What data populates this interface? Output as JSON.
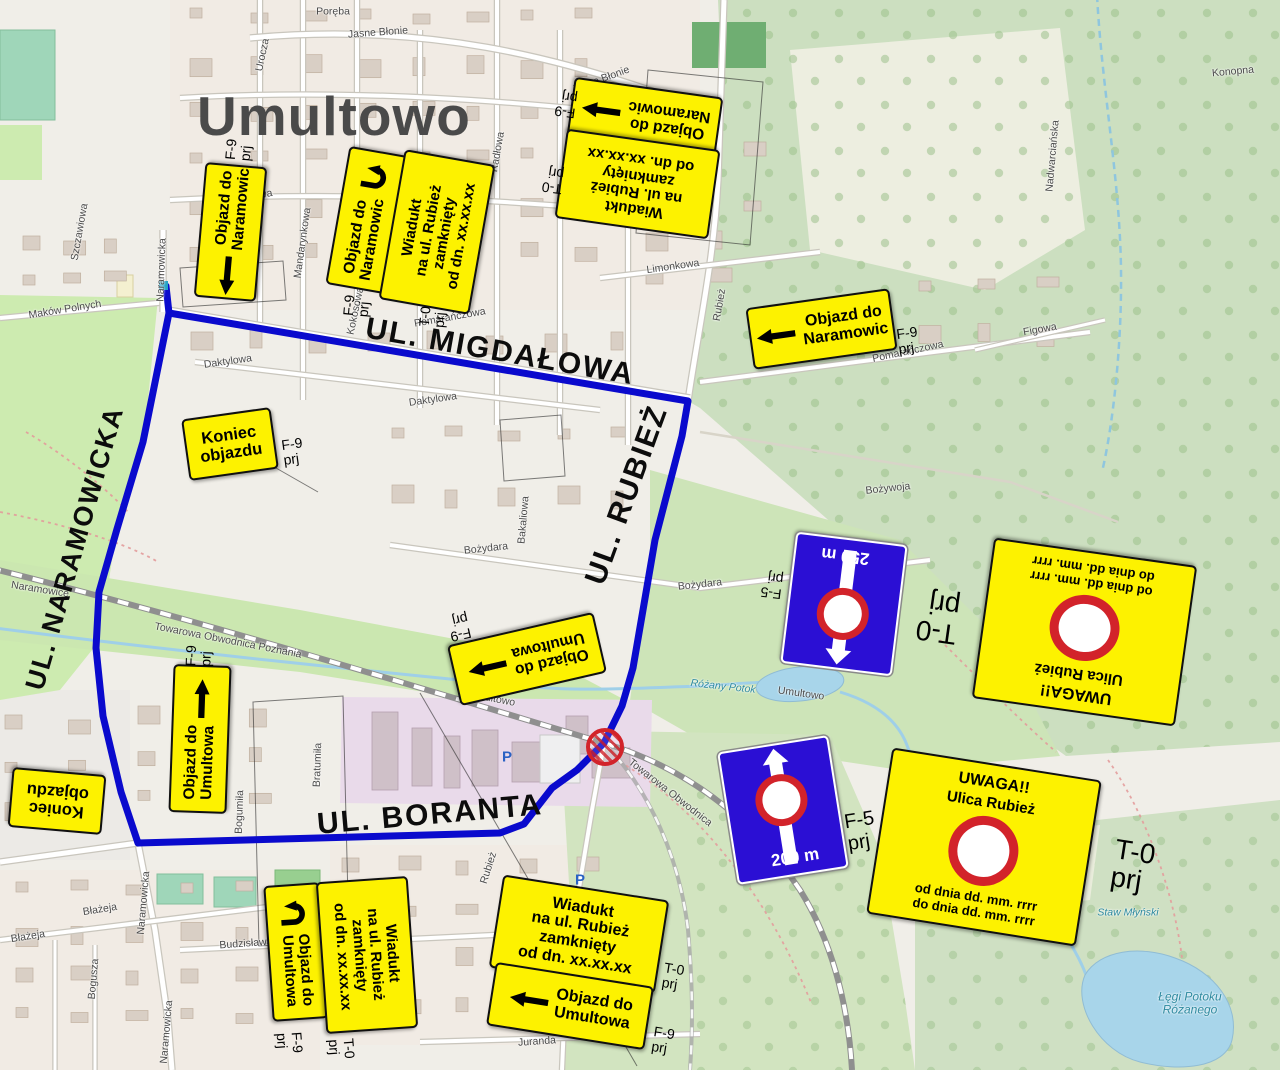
{
  "title": "Umultowo",
  "colors": {
    "route_blue": "#0a0acd",
    "sign_yellow": "#fdf200",
    "sign_blue": "#2b0fd4",
    "prohibition_red": "#d2232a",
    "title_gray": "#4a4a4a"
  },
  "main_streets": {
    "migdalowa": "UL. MIGDAŁOWA",
    "rubiez": "UL. RUBIEŻ",
    "naramowicka": "UL. NARAMOWICKA",
    "boranta": "UL. BORANTA"
  },
  "signs": {
    "objazd_naramowic": "Objazd do\nNaramowic",
    "objazd_umultowa": "Objazd do\nUmultowa",
    "wiadukt": "Wiadukt\nna ul. Rubież\nzamknięty\nod dn. xx.xx.xx",
    "koniec": "Koniec\nobjazdu",
    "uwaga_title": "UWAGA!!",
    "uwaga_subtitle": "Ulica Rubież",
    "uwaga_dates": "od dnia dd. mm. rrrr\ndo dnia dd. mm. rrrr",
    "f5_250": "250 m",
    "f5_200": "200 m"
  },
  "aux_labels": {
    "f9": "F-9\nprj",
    "t0": "T-0\nprj",
    "f5": "F-5\nprj"
  },
  "icons": {
    "parking": "P"
  },
  "map_labels": [
    {
      "t": "Jasne Błonie",
      "x": 378,
      "y": 33,
      "r": -4
    },
    {
      "t": "Jasne Błonie",
      "x": 601,
      "y": 80,
      "r": -20
    },
    {
      "t": "Urocza",
      "x": 263,
      "y": 55,
      "r": -78
    },
    {
      "t": "Poręba",
      "x": 333,
      "y": 12,
      "r": 0
    },
    {
      "t": "Radłowa",
      "x": 498,
      "y": 152,
      "r": -80
    },
    {
      "t": "Koprowa",
      "x": 252,
      "y": 197,
      "r": -10
    },
    {
      "t": "Mandarynkowa",
      "x": 303,
      "y": 243,
      "r": -82
    },
    {
      "t": "Szczawiowa",
      "x": 80,
      "y": 232,
      "r": -80
    },
    {
      "t": "Maków Polnych",
      "x": 65,
      "y": 310,
      "r": -9
    },
    {
      "t": "Kokosowa",
      "x": 356,
      "y": 311,
      "r": -78
    },
    {
      "t": "Pomarańczowa",
      "x": 450,
      "y": 318,
      "r": -10
    },
    {
      "t": "Pomarańczowa",
      "x": 908,
      "y": 352,
      "r": -12
    },
    {
      "t": "Limonkowa",
      "x": 673,
      "y": 267,
      "r": -8
    },
    {
      "t": "Figowa",
      "x": 1040,
      "y": 330,
      "r": -10
    },
    {
      "t": "Daktylowa",
      "x": 228,
      "y": 362,
      "r": -8
    },
    {
      "t": "Daktylowa",
      "x": 433,
      "y": 400,
      "r": -8
    },
    {
      "t": "Bakaliowa",
      "x": 524,
      "y": 520,
      "r": -85
    },
    {
      "t": "Bożydara",
      "x": 486,
      "y": 549,
      "r": -6
    },
    {
      "t": "Bożydara",
      "x": 700,
      "y": 585,
      "r": -6
    },
    {
      "t": "Bożywoja",
      "x": 888,
      "y": 489,
      "r": -6
    },
    {
      "t": "Rubież",
      "x": 720,
      "y": 305,
      "r": -80
    },
    {
      "t": "Rubież",
      "x": 489,
      "y": 868,
      "r": -72
    },
    {
      "t": "Naramowicka",
      "x": 162,
      "y": 270,
      "r": -88
    },
    {
      "t": "Naramowicka",
      "x": 144,
      "y": 903,
      "r": -85
    },
    {
      "t": "Naramowicka",
      "x": 167,
      "y": 1032,
      "r": -85
    },
    {
      "t": "Towarowa Obwodnica Poznania",
      "x": 228,
      "y": 641,
      "r": 11
    },
    {
      "t": "Towarowa Obwodnica",
      "x": 670,
      "y": 793,
      "r": 38
    },
    {
      "t": "Umultowo",
      "x": 492,
      "y": 699,
      "r": 11
    },
    {
      "t": "Umultowo",
      "x": 801,
      "y": 694,
      "r": 8
    },
    {
      "t": "Naramowice",
      "x": 40,
      "y": 590,
      "r": 9
    },
    {
      "t": "Różany Potok",
      "x": 723,
      "y": 687,
      "r": 6,
      "c": "water"
    },
    {
      "t": "Błażeja",
      "x": 100,
      "y": 910,
      "r": -9
    },
    {
      "t": "Błażeja",
      "x": 28,
      "y": 937,
      "r": -9
    },
    {
      "t": "Bogusza",
      "x": 94,
      "y": 979,
      "r": -85
    },
    {
      "t": "Budzisława",
      "x": 246,
      "y": 944,
      "r": -4
    },
    {
      "t": "Bogumiła",
      "x": 240,
      "y": 812,
      "r": -88
    },
    {
      "t": "Bratumiła",
      "x": 318,
      "y": 765,
      "r": -88
    },
    {
      "t": "Juranda",
      "x": 537,
      "y": 1042,
      "r": -4
    },
    {
      "t": "Nadwarciańska",
      "x": 1053,
      "y": 156,
      "r": -85
    },
    {
      "t": "Konopna",
      "x": 1233,
      "y": 72,
      "r": -5
    },
    {
      "t": "Staw Młyński",
      "x": 1128,
      "y": 913,
      "r": 0,
      "c": "water"
    },
    {
      "t": "Łęgi Potoku\nRóżanego",
      "x": 1190,
      "y": 1003,
      "r": 0,
      "c": "water big"
    }
  ]
}
